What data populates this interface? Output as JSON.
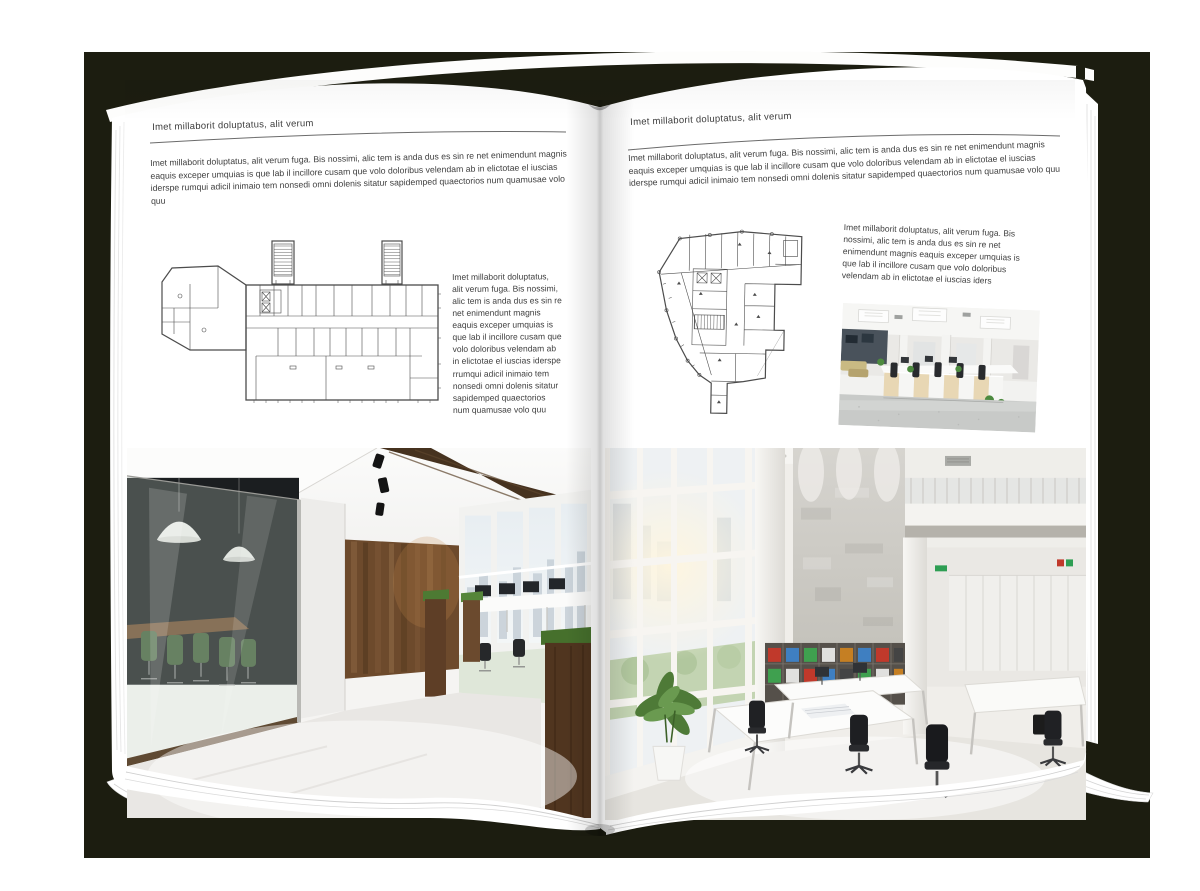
{
  "document": {
    "type": "open-magazine-spread-mockup",
    "colors": {
      "backdrop": "#1c1d10",
      "page": "#ffffff",
      "text": "#3f3f3f",
      "rule": "#6b6b6b"
    }
  },
  "left_page": {
    "header": "Imet millaborit doluptatus, alit verum",
    "intro": "Imet millaborit doluptatus, alit verum fuga. Bis nossimi, alic tem is anda dus es sin re net enimendunt magnis eaquis exceper umquias is que lab il incillore cusam que volo doloribus velendam ab in elictotae el iuscias iderspe rumqui adicil inimaio tem nonsedi omni dolenis sitatur sapidemped quaectorios num quamusae volo quu",
    "side_text": "Imet millaborit doluptatus, alit verum fuga. Bis nossimi, alic tem is anda dus es sin re net enimendunt magnis eaquis exceper umquias is que lab il incillore cusam que volo doloribus velendam ab in elictotae el iuscias iderspe rrumqui adicil inimaio tem nonsedi omni dolenis sitatur sapidemped quaectorios num quamusae volo quu"
  },
  "right_page": {
    "header": "Imet millaborit doluptatus, alit verum",
    "intro": "Imet millaborit doluptatus, alit verum fuga. Bis nossimi, alic tem is anda dus es sin re net enimendunt magnis eaquis exceper umquias is que lab il incillore cusam que volo doloribus velendam ab in elictotae el iuscias iderspe rumqui adicil inimaio tem nonsedi omni dolenis sitatur sapidemped quaectorios num quamusae volo quu",
    "side_text": "Imet millaborit doluptatus, alit verum fuga. Bis nossimi, alic tem is anda dus es sin re net enimendunt magnis eaquis exceper umquias is que lab il incillore cusam que volo doloribus velendam ab in elictotae el iuscias iders"
  }
}
